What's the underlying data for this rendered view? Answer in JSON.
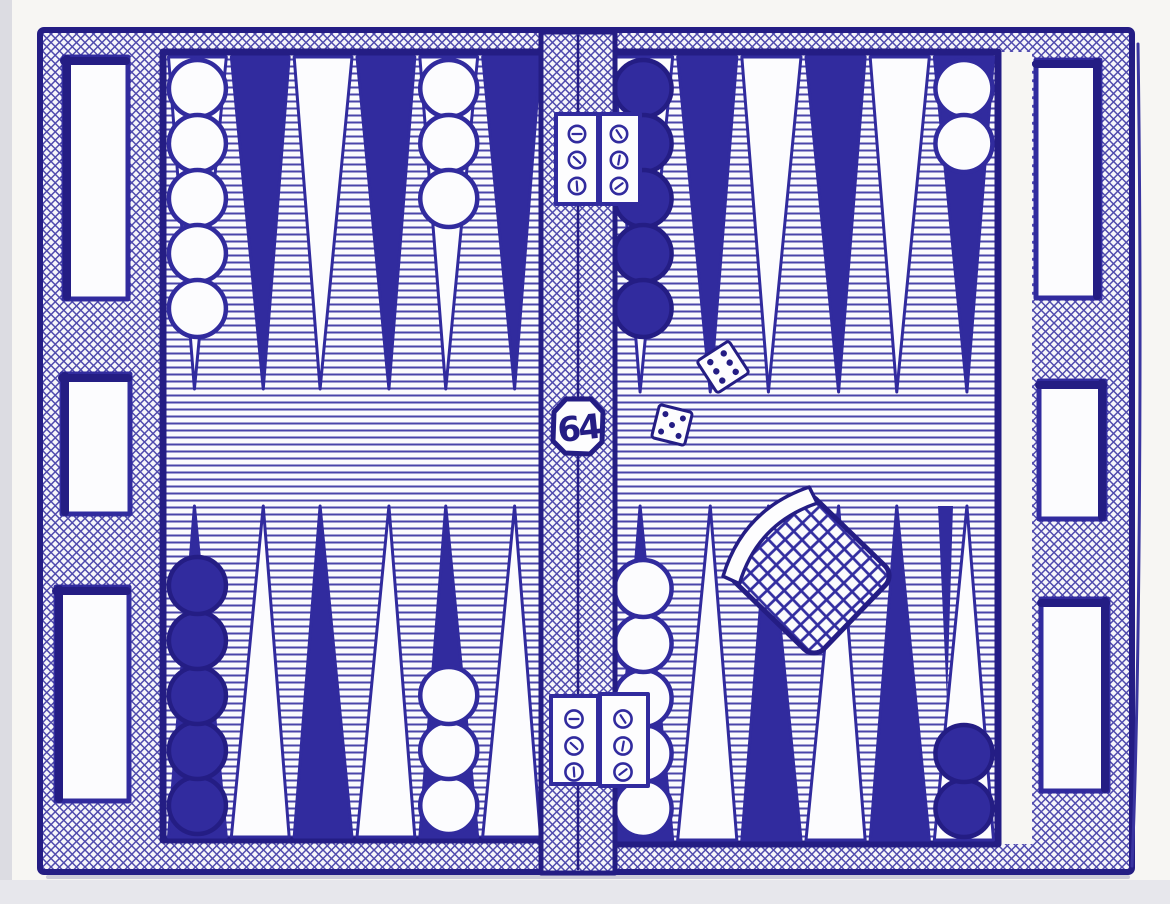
{
  "artwork": {
    "subject": "Backgammon board in an open case, drawn in blue ballpoint pen on white paper"
  },
  "colors": {
    "ink": "#312b9e",
    "ink_dark": "#241d84",
    "stripe": "#4a45a9",
    "cross": "#4f4aad",
    "paper": "#f7f6f3",
    "white": "#fcfcfe"
  },
  "doubling_cube": {
    "value": "64"
  },
  "dice": [
    {
      "value": 6
    },
    {
      "value": 5
    }
  ],
  "dice_cup": {
    "present": true,
    "texture": "crosshatch"
  },
  "hinges": {
    "count": 2,
    "screws_per_hinge": 6
  },
  "case": {
    "left_slots": 3,
    "right_slots": 3
  },
  "board": {
    "quadrants": {
      "top_left": {
        "points": [
          {
            "color": "white",
            "checkers": {
              "color": "white",
              "count": 5
            }
          },
          {
            "color": "dark"
          },
          {
            "color": "white"
          },
          {
            "color": "dark"
          },
          {
            "color": "white",
            "checkers": {
              "color": "white",
              "count": 3
            }
          },
          {
            "color": "dark"
          }
        ]
      },
      "top_right": {
        "points": [
          {
            "color": "white",
            "checkers": {
              "color": "dark",
              "count": 5
            }
          },
          {
            "color": "dark"
          },
          {
            "color": "white"
          },
          {
            "color": "dark"
          },
          {
            "color": "white"
          },
          {
            "color": "dark",
            "checkers": {
              "color": "white",
              "count": 2
            }
          }
        ]
      },
      "bottom_left": {
        "points": [
          {
            "color": "dark",
            "checkers": {
              "color": "dark",
              "count": 5
            }
          },
          {
            "color": "white"
          },
          {
            "color": "dark"
          },
          {
            "color": "white"
          },
          {
            "color": "dark",
            "checkers": {
              "color": "white",
              "count": 3
            }
          },
          {
            "color": "white"
          }
        ]
      },
      "bottom_right": {
        "points": [
          {
            "color": "dark",
            "checkers": {
              "color": "white",
              "count": 5
            }
          },
          {
            "color": "white"
          },
          {
            "color": "dark"
          },
          {
            "color": "white"
          },
          {
            "color": "dark"
          },
          {
            "color": "white",
            "checkers": {
              "color": "dark",
              "count": 2
            }
          }
        ]
      }
    }
  }
}
